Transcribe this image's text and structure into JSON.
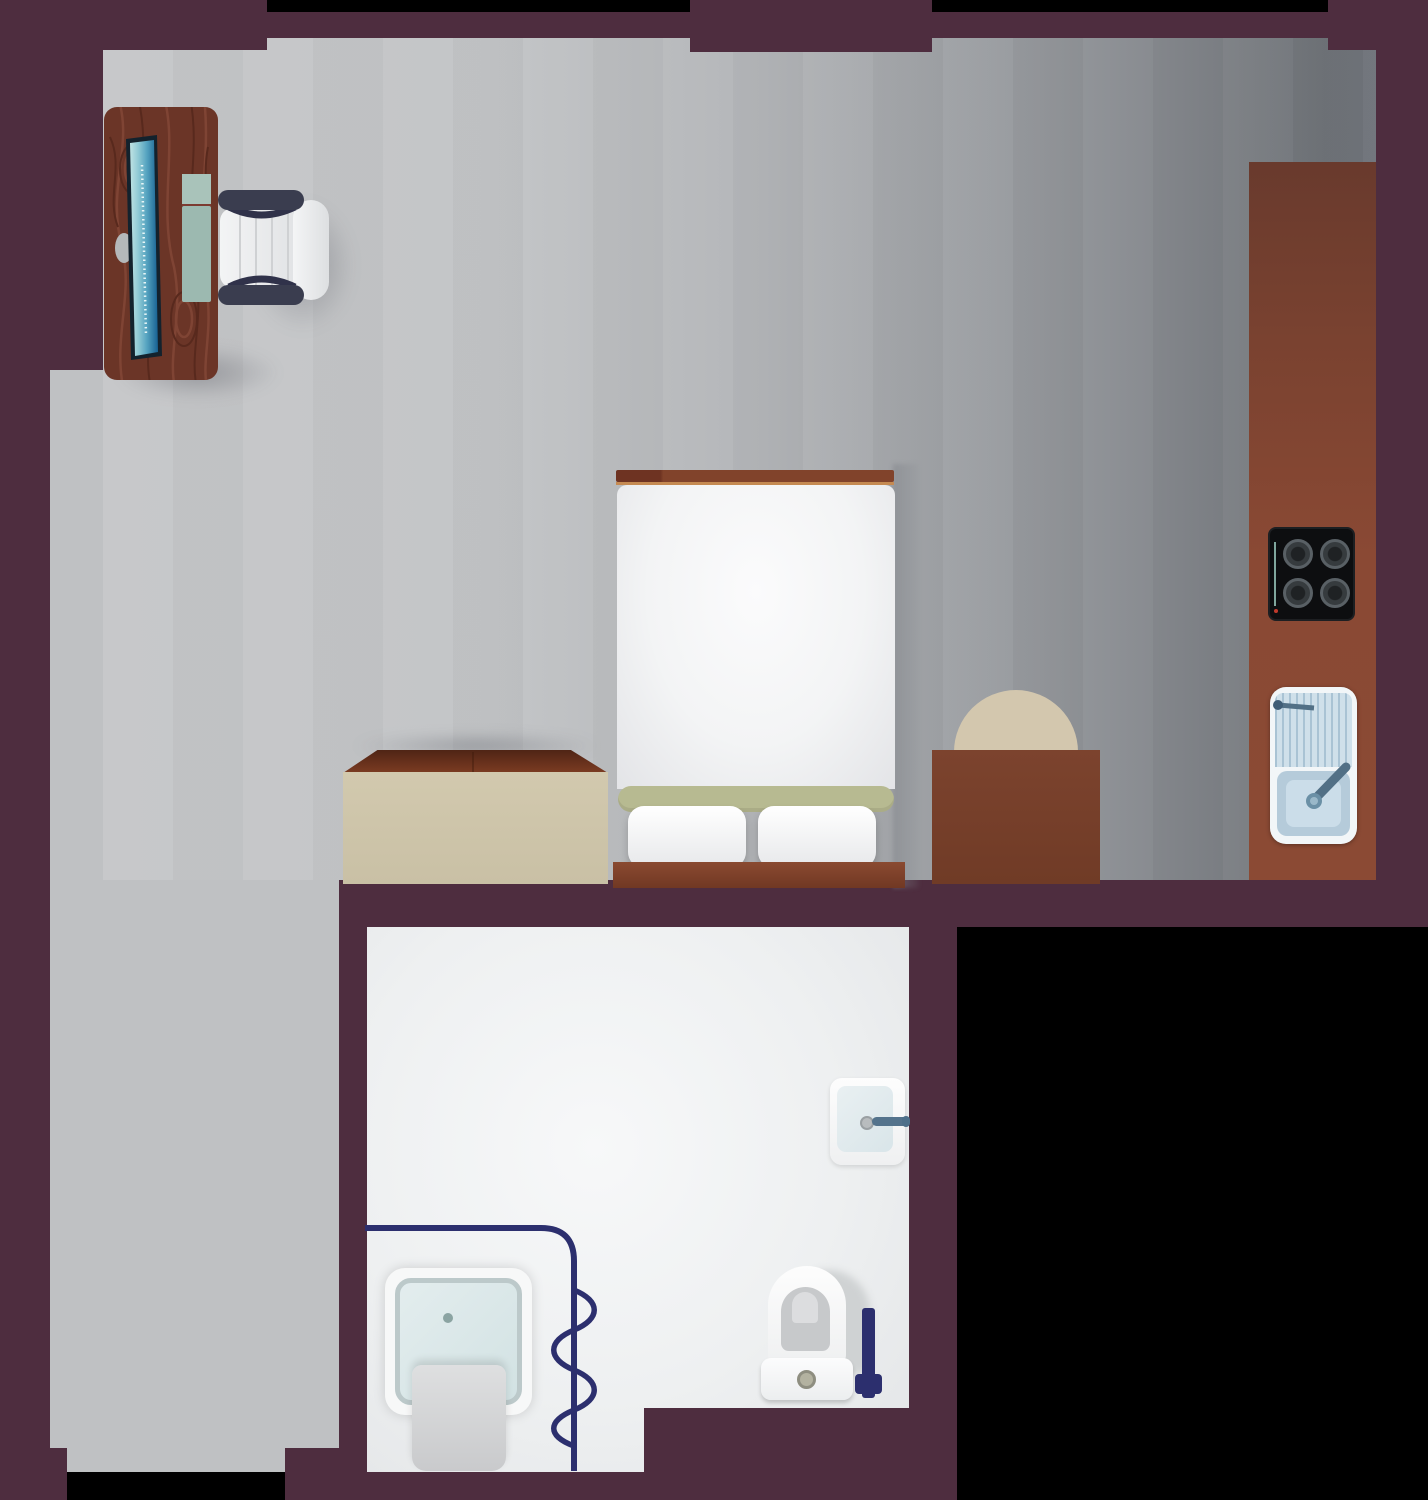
{
  "meta": {
    "name": "studio apartment floor plan",
    "view": "top-down illustration",
    "text_labels": []
  },
  "palette": {
    "background": "#000000",
    "wall": "#4e2d3f",
    "floor_light": "#c6c7c9",
    "floor_dark": "#6f7378",
    "corridor": "#bfc1c3",
    "bathroom_floor": "#f0f1f2",
    "counter": "#8a4934",
    "wood_desk": "#6b3527",
    "wood_grain_light": "#7f4434",
    "wood_grain_dark": "#58291d",
    "bed_frame": "#7d4129",
    "bed_trim": "#c58a52",
    "duvet": "#f7f8f9",
    "blanket_band": "#b7ba91",
    "pillow": "#ffffff",
    "dresser_front": "#cdc4a9",
    "dresser_top": "#7c3c22",
    "seat_round": "#d3c7ae",
    "side_table": "#7c432e",
    "stove_body": "#0d0e10",
    "burner_ring": "#596065",
    "stove_indicator": "#9ccdc0",
    "stove_dot": "#c0392b",
    "sink_body": "#f2f6f8",
    "sink_blue": "#cfe0ea",
    "sink_stripe": "#a9c3d4",
    "basin": "#b5cbda",
    "faucet": "#54738c",
    "navy": "#2c2f6e",
    "fixture_white": "#f7f8f8",
    "tray_border": "#bcc9ca",
    "mat": "#d0d1d3",
    "toilet_inner": "#c7c9cb",
    "toilet_u": "#dcdddf",
    "button": "#b3b2a0",
    "monitor_frame": "#13222d",
    "screen_light": "#bfe3e4",
    "screen_dark": "#176091",
    "keyboard": "#9cb9b0",
    "keyboard_top": "#a9c3ba",
    "armrest": "#3a3d4f",
    "chair_seat": "#f0f1f2"
  },
  "rooms": [
    {
      "id": "main-room",
      "floor": "grey gradient"
    },
    {
      "id": "kitchen-strip",
      "floor": "grey gradient"
    },
    {
      "id": "corridor",
      "floor": "grey"
    },
    {
      "id": "bathroom",
      "floor": "white"
    }
  ],
  "furniture": [
    {
      "id": "desk",
      "room": "main-room"
    },
    {
      "id": "monitor",
      "room": "main-room"
    },
    {
      "id": "keyboard",
      "room": "main-room"
    },
    {
      "id": "office-chair",
      "room": "main-room"
    },
    {
      "id": "double-bed",
      "room": "main-room"
    },
    {
      "id": "pillow-left",
      "room": "main-room"
    },
    {
      "id": "pillow-right",
      "room": "main-room"
    },
    {
      "id": "dresser",
      "room": "main-room"
    },
    {
      "id": "accent-chair",
      "room": "main-room"
    },
    {
      "id": "side-table",
      "room": "main-room"
    },
    {
      "id": "kitchen-counter",
      "room": "kitchen-strip"
    },
    {
      "id": "stove-top",
      "room": "kitchen-strip"
    },
    {
      "id": "kitchen-sink",
      "room": "kitchen-strip"
    },
    {
      "id": "bathroom-sink",
      "room": "bathroom"
    },
    {
      "id": "shower-tray",
      "room": "bathroom"
    },
    {
      "id": "shower-curtain",
      "room": "bathroom"
    },
    {
      "id": "bath-mat",
      "room": "bathroom"
    },
    {
      "id": "toilet",
      "room": "bathroom"
    },
    {
      "id": "toilet-brush",
      "room": "bathroom"
    }
  ]
}
